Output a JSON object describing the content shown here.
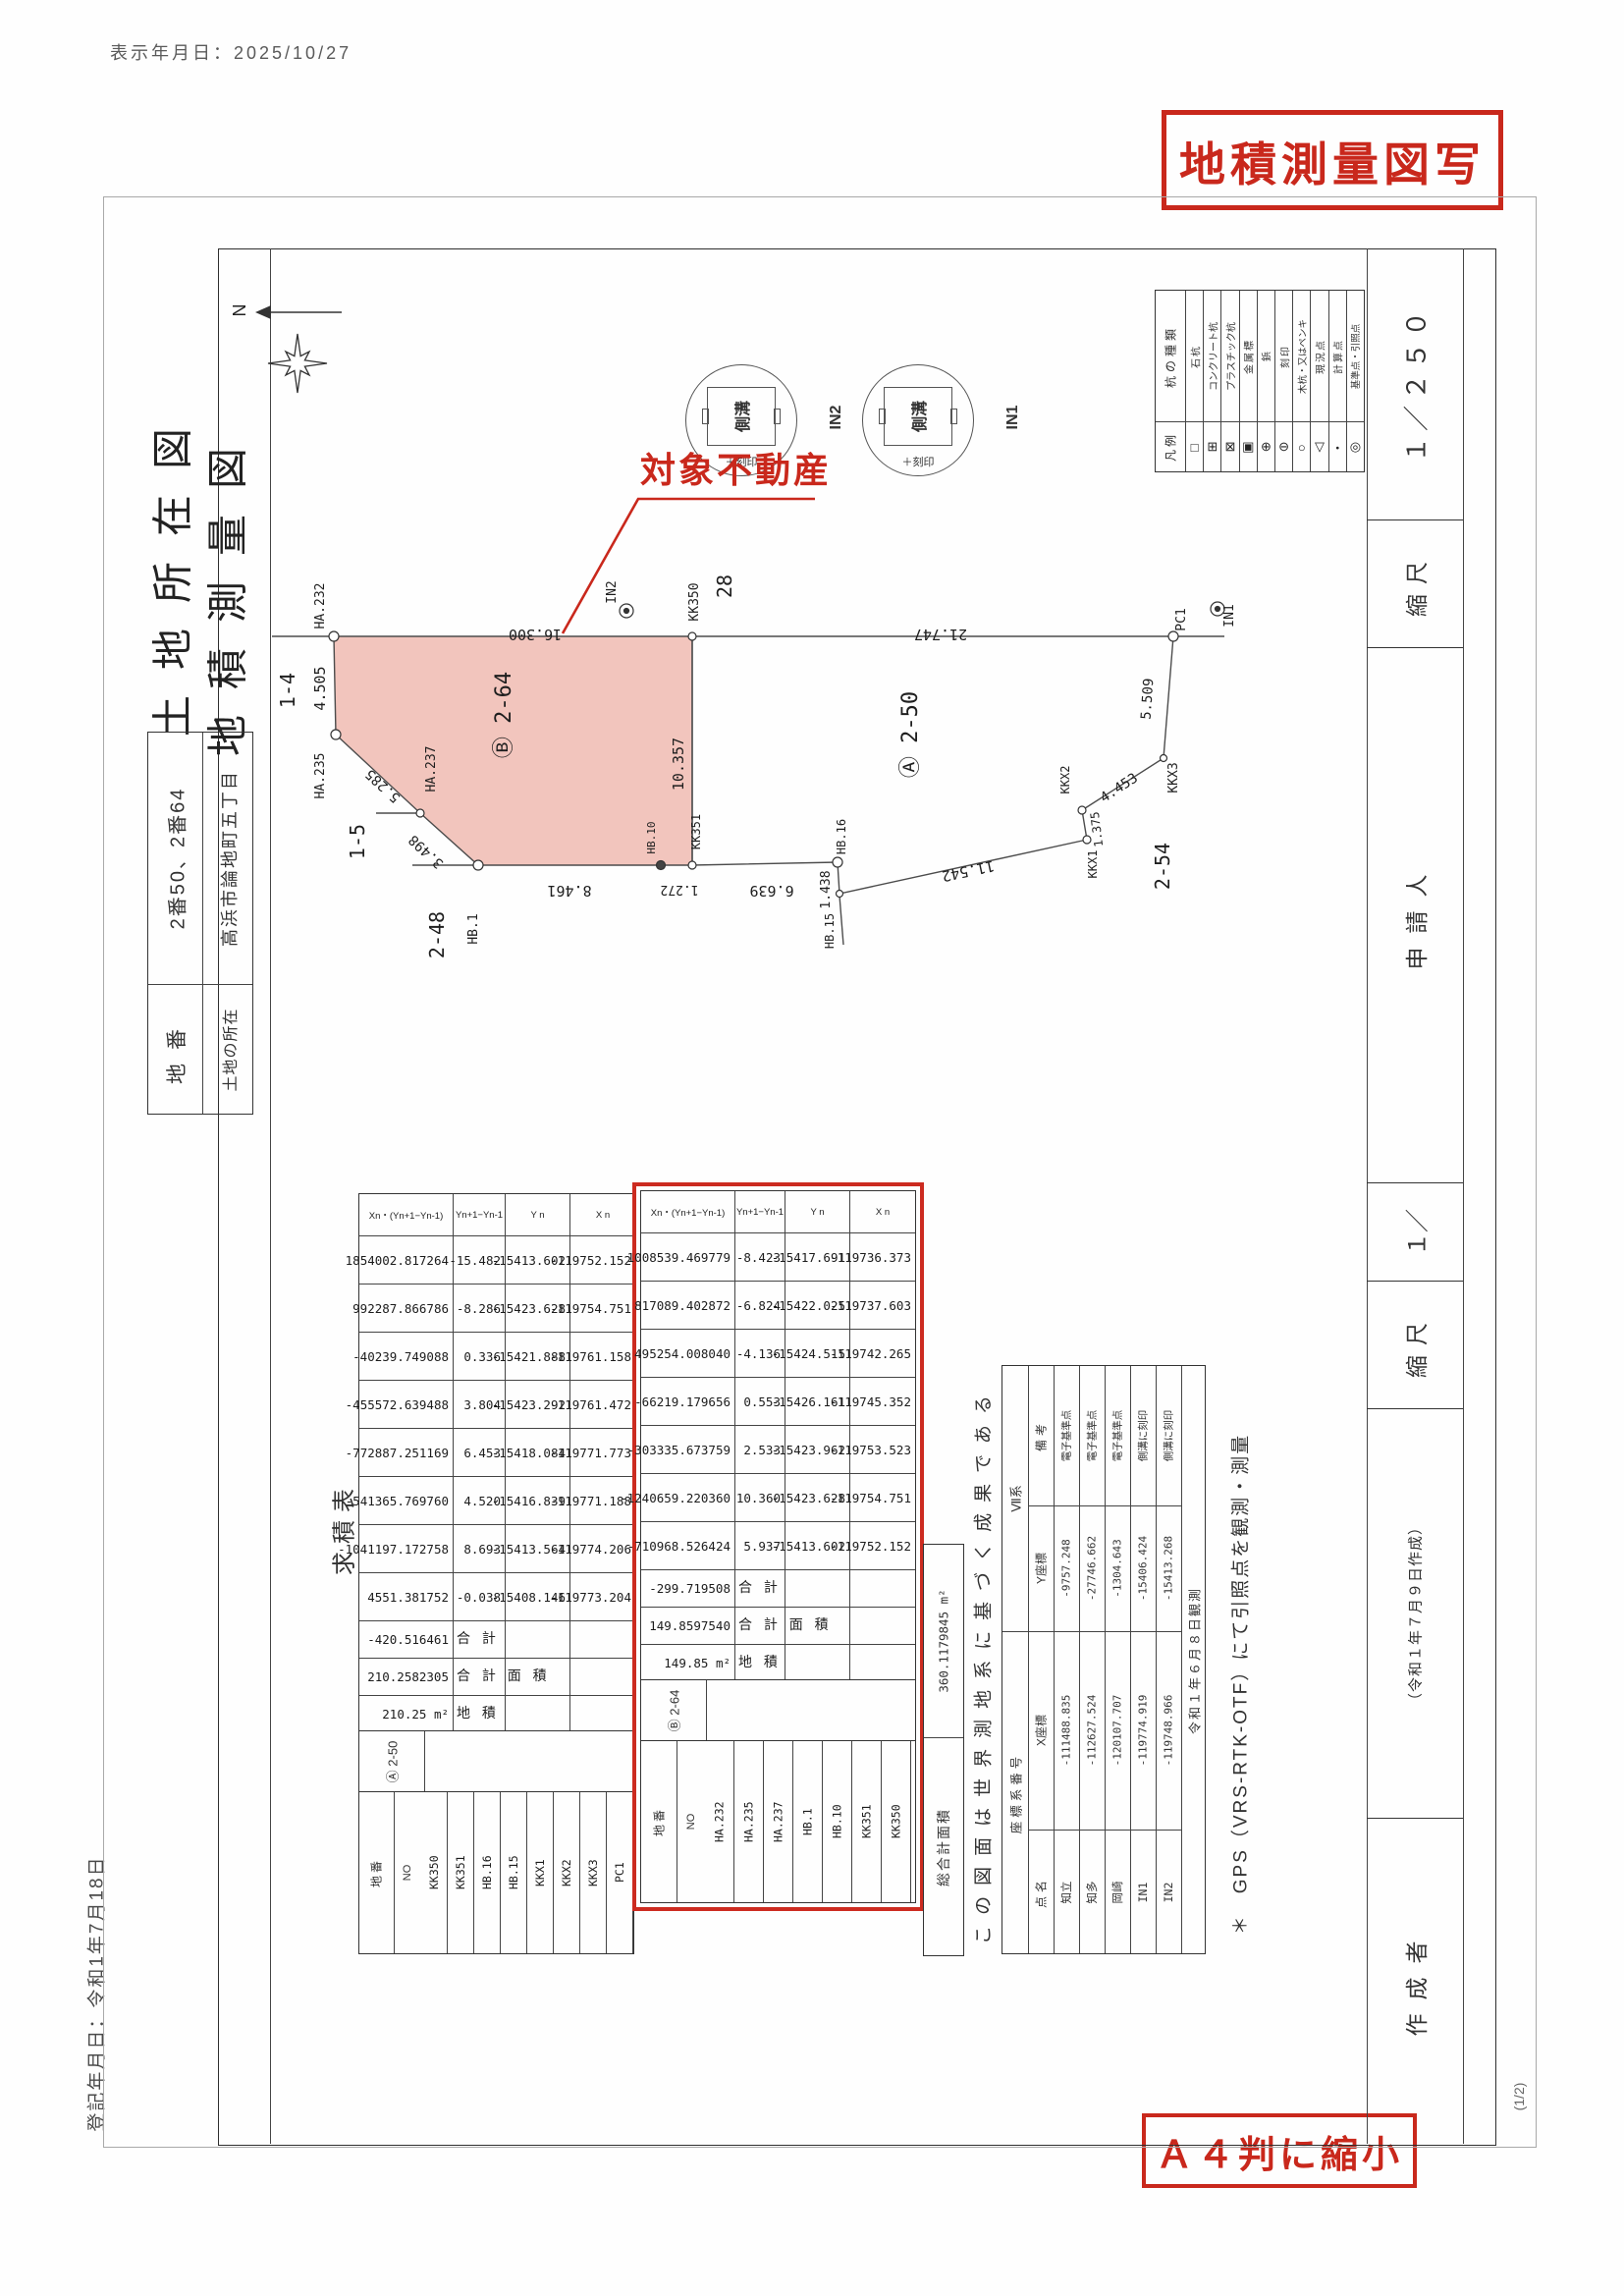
{
  "page": {
    "display_date": "表示年月日：2025/10/27",
    "registered_date": "登記年月日：令和1年7月18日",
    "stamp_copy": "地積測量図写",
    "stamp_a4": "Ａ４判に縮小",
    "page_no": "(1/2)"
  },
  "form": {
    "title_line1": "土地所在図",
    "title_line2": "地積測量図",
    "parcel_block": {
      "chiban_label": "地番",
      "chiban_value": "2番50、2番64",
      "location_label": "土地の所在",
      "location_value": "高浜市論地町五丁目"
    },
    "strip": {
      "scale_value": "１／２５０",
      "scale_label": "縮尺",
      "applicant_label": "申請人",
      "scale2_value": "１／",
      "scale2_label": "縮尺",
      "created_date": "（令和１年７月９日作成）",
      "author_label": "作成者"
    }
  },
  "legend": {
    "header_type": "杭の種類",
    "header_legend": "凡例",
    "labels": [
      "石杭",
      "コンクリート杭",
      "プラスチック杭",
      "金属標",
      "鋲",
      "刻印",
      "木杭・又はペンキ",
      "現況点",
      "計算点",
      "基準点・引照点"
    ],
    "symbols": [
      "□",
      "⊞",
      "⊠",
      "▣",
      "⊕",
      "⊖",
      "○",
      "▽",
      "・",
      "◎"
    ]
  },
  "map": {
    "north_label": "N",
    "subject_label": "対象不動産",
    "parcel_b": "Ⓑ 2-64",
    "parcel_a": "Ⓐ 2-50",
    "adj_14": "1-4",
    "adj_15": "1-5",
    "adj_248": "2-48",
    "adj_28": "28",
    "adj_254": "2-54",
    "points": {
      "ha232": "HA.232",
      "ha235": "HA.235",
      "ha237": "HA.237",
      "hb1": "HB.1",
      "hb10": "HB.10",
      "kk351": "KK351",
      "kk350": "KK350",
      "hb16": "HB.16",
      "hb15": "HB.15",
      "kkx1": "KKX1",
      "kkx2": "KKX2",
      "kkx3": "KKX3",
      "pc1": "PC1",
      "in1": "IN1",
      "in2": "IN2"
    },
    "dims": {
      "b_top": "16.300",
      "b_left": "4.505",
      "b_diag1": "5.285",
      "b_diag2": "3.498",
      "b_bottom1": "8.461",
      "b_bottom2": "1.272",
      "b_right": "10.357",
      "a_top": "21.747",
      "a_bottom1": "6.639",
      "a_jog": "1.438",
      "a_bottom2": "11.542",
      "a_jog2": "1.375",
      "a_diag": "4.453",
      "a_right": "5.509"
    },
    "detail": {
      "in2": "IN2",
      "in1": "IN1",
      "gutter": "側溝",
      "mark": "＋刻印"
    }
  },
  "survey": {
    "section_label": "求積表",
    "headers": {
      "parcel": "地番",
      "no": "NO",
      "xn": "X n",
      "yn": "Y n",
      "dy": "Yn+1−Yn-1",
      "prod": "Xn・(Yn+1−Yn-1)",
      "total": "合 計",
      "total_area": "合 計 面 積",
      "area": "地 積"
    },
    "tables": [
      {
        "parcel_id": "Ⓐ 2-50",
        "points": [
          "KK350",
          "KK351",
          "HB.16",
          "HB.15",
          "KKX1",
          "KKX2",
          "KKX3",
          "PC1"
        ],
        "xn": [
          "-119752.152",
          "-119754.751",
          "-119761.158",
          "-119761.472",
          "-119771.773",
          "-119771.188",
          "-119774.206",
          "-119773.204"
        ],
        "yn": [
          "-15413.602",
          "-15423.628",
          "-15421.888",
          "-15423.292",
          "-15418.084",
          "-15416.839",
          "-15413.564",
          "-15408.146"
        ],
        "dy": [
          "-15.482",
          "-8.286",
          "0.336",
          "3.804",
          "6.453",
          "4.520",
          "8.693",
          "-0.038"
        ],
        "prod": [
          "1854002.817264",
          "992287.866786",
          "-40239.749088",
          "-455572.639488",
          "-772887.251169",
          "-541365.769760",
          "-1041197.172758",
          "4551.381752"
        ],
        "total": "-420.516461",
        "total_area": "210.2582305",
        "area": "210.25 m²"
      },
      {
        "parcel_id": "Ⓑ 2-64",
        "points": [
          "HA.232",
          "HA.235",
          "HA.237",
          "HB.1",
          "HB.10",
          "KK351",
          "KK350"
        ],
        "xn": [
          "-119736.373",
          "-119737.603",
          "-119742.265",
          "-119745.352",
          "-119753.523",
          "-119754.751",
          "-119752.152"
        ],
        "yn": [
          "-15417.691",
          "-15422.025",
          "-15424.515",
          "-15426.161",
          "-15423.962",
          "-15423.628",
          "-15413.602"
        ],
        "dy": [
          "-8.423",
          "-6.824",
          "-4.136",
          "0.553",
          "2.533",
          "10.360",
          "5.937"
        ],
        "prod": [
          "1008539.469779",
          "817089.402872",
          "495254.008040",
          "-66219.179656",
          "-303335.673759",
          "-1240659.220360",
          "-710968.526424"
        ],
        "total": "-299.719508",
        "total_area": "149.8597540",
        "area": "149.85 m²"
      }
    ]
  },
  "total_box": {
    "label": "総合計面積",
    "value": "360.1179845 m²"
  },
  "notes": {
    "datum": "この図面は世界測地系に基づく成果である",
    "gps": "＊　GPS（VRS-RTK-OTF）にて引照点を観測・測量"
  },
  "coord": {
    "sys_label": "座標系番号",
    "sys_value": "Ⅶ系",
    "headers": {
      "name": "点名",
      "x": "X座標",
      "y": "Y座標",
      "remark": "備考"
    },
    "rows": [
      [
        "知立",
        "-111488.835",
        "-9757.248",
        "電子基準点"
      ],
      [
        "知多",
        "-112627.524",
        "-27746.662",
        "電子基準点"
      ],
      [
        "岡崎",
        "-120107.707",
        "-1304.643",
        "電子基準点"
      ],
      [
        "IN1",
        "-119774.919",
        "-15406.424",
        "側溝に刻印"
      ],
      [
        "IN2",
        "-119748.966",
        "-15413.268",
        "側溝に刻印"
      ]
    ],
    "obs_note": "令和１年６月８日観測"
  }
}
